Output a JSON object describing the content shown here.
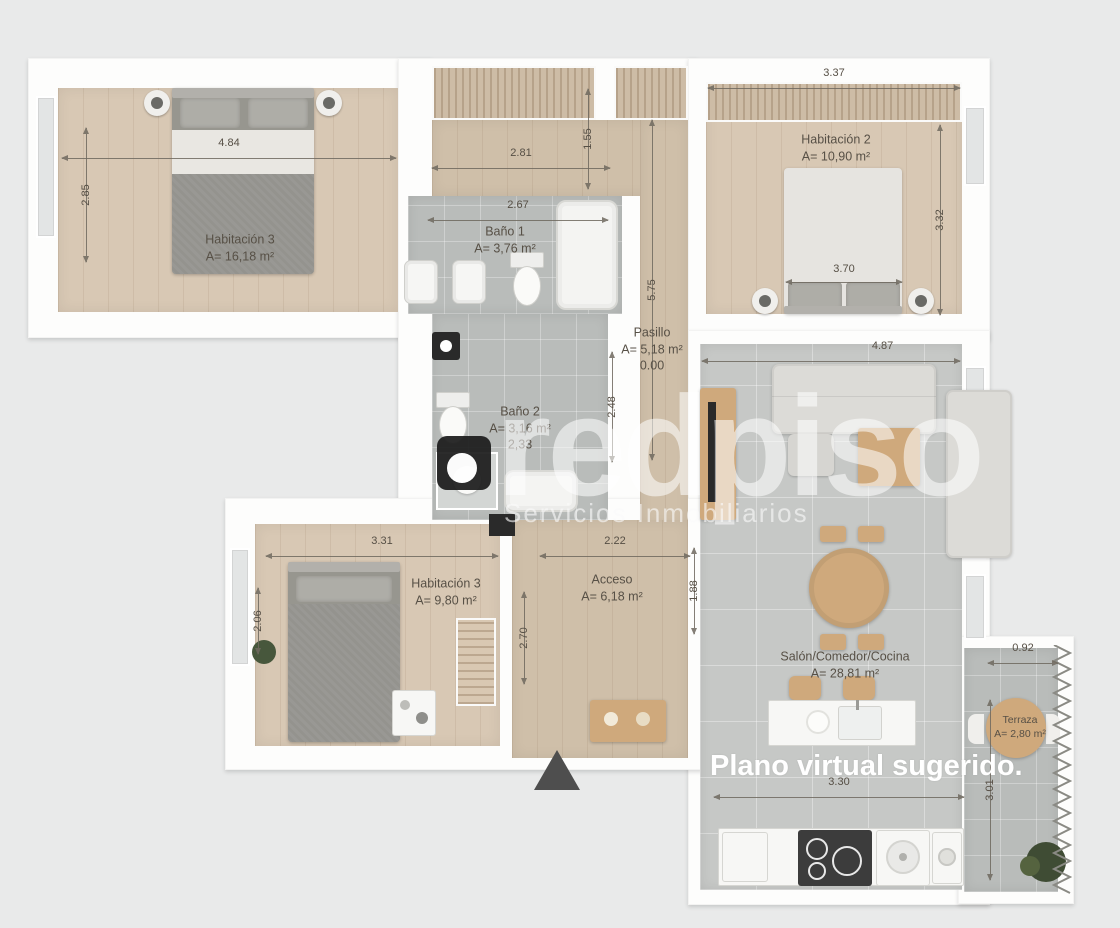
{
  "overlay": {
    "caption": "Plano virtual sugerido."
  },
  "branding": {
    "logo": "redpiso-logo",
    "title": "redpiso",
    "subtitle": "Servicios Inmobiliarios"
  },
  "rooms": {
    "hab3_top": {
      "name": "Habitación 3",
      "area": "A= 16,18 m²"
    },
    "bano1": {
      "name": "Baño 1",
      "area": "A= 3,76 m²"
    },
    "hab2": {
      "name": "Habitación 2",
      "area": "A= 10,90 m²"
    },
    "pasillo": {
      "name": "Pasillo",
      "area": "A= 5,18 m²"
    },
    "bano2": {
      "name": "Baño 2",
      "area": "A= 3,16 m²"
    },
    "hab3_bottom": {
      "name": "Habitación 3",
      "area": "A= 9,80 m²"
    },
    "acceso": {
      "name": "Acceso",
      "area": "A= 6,18 m²"
    },
    "salon": {
      "name": "Salón/Comedor/Cocina",
      "area": "A= 28,81 m²"
    },
    "terraza": {
      "name": "Terraza",
      "area": "A= 2,80 m²"
    }
  },
  "dims": {
    "hab3_width": "4.84",
    "hab3_height": "2.85",
    "hall_width": "2.81",
    "bano1_width": "2.67",
    "hab2_width": "3.37",
    "hab2_height": "3.32",
    "hab2_bed": "3.70",
    "hall_depth": "1.55",
    "pasillo_height": "5.75",
    "pasillo_zero": "0.00",
    "bano2_height": "2.48",
    "bano2_width": "2,33",
    "habb_width": "3.31",
    "habb_left": "2.06",
    "habb_right": "2.70",
    "acceso_width": "2.22",
    "salon_width": "4.87",
    "salon_left": "1.88",
    "kitchen_width": "3.30",
    "terraza_width": "0.92",
    "terraza_height": "3.01"
  },
  "colors": {
    "background": "#e9eaea",
    "wall": "#fdfdfc",
    "wood_floor": "#d8c8b4",
    "tile_floor": "#b9bcba",
    "salon_tile": "#c6c8c6",
    "furniture_gray": "#97968f",
    "furniture_wood": "#cfa97c",
    "dimension_text": "#564f45",
    "caption_text": "#ffffff"
  }
}
